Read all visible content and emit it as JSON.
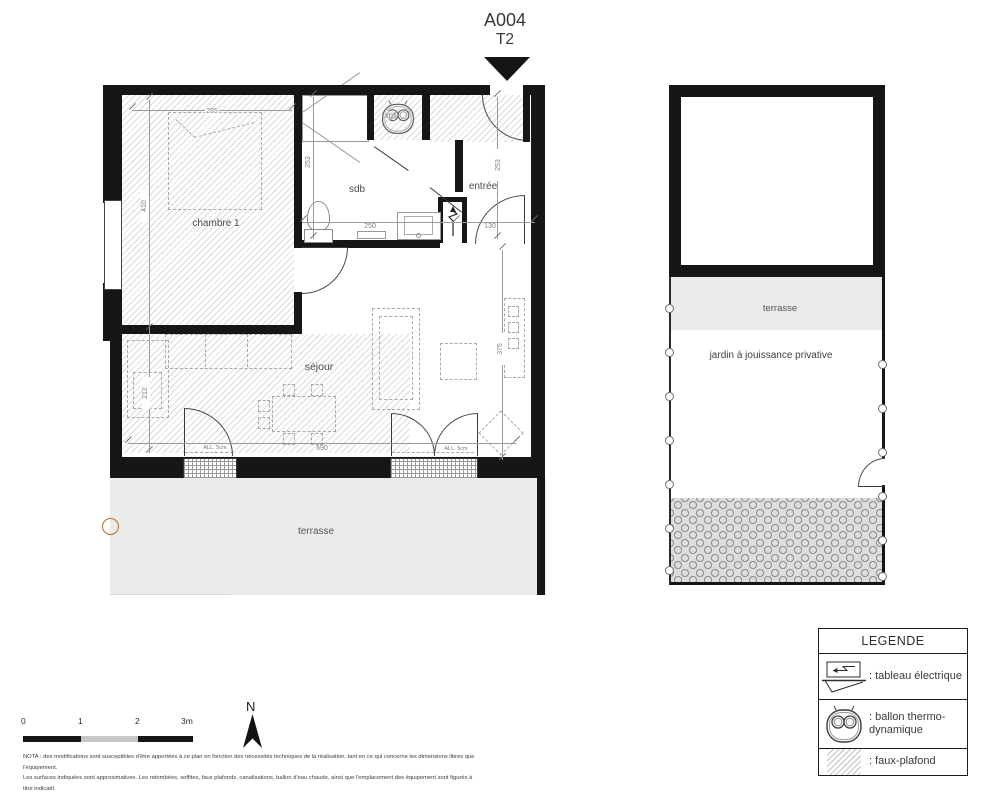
{
  "title": {
    "lot": "A004",
    "unit_type": "T2"
  },
  "plan": {
    "rooms": {
      "chambre": "chambre 1",
      "sdb": "sdb",
      "rgt": "rgt",
      "entree": "entrée",
      "sejour": "séjour",
      "terrasse": "terrasse"
    },
    "dims": {
      "chambre_width": "285",
      "chambre_height": "410",
      "sdb_height": "253",
      "sdb_width": "250",
      "entree_height": "253",
      "entree_width": "130",
      "sejour_width": "690",
      "sejour_height": "375",
      "cuisine_height": "212"
    },
    "windows": {
      "left_allege": "ALL. 5cm",
      "right_allege": "ALL. 5cm"
    }
  },
  "site": {
    "terrasse": "terrasse",
    "jardin": "jardin à jouissance privative"
  },
  "legend": {
    "title": "LEGENDE",
    "items": [
      {
        "name": "tableau-electrique",
        "label": ": tableau électrique"
      },
      {
        "name": "ballon-thermodynamique",
        "label": ": ballon thermo-dynamique"
      },
      {
        "name": "faux-plafond",
        "label": ": faux-plafond"
      }
    ]
  },
  "scalebar": {
    "t0": "0",
    "t1": "1",
    "t2": "2",
    "t3": "3m"
  },
  "compass": {
    "north": "N"
  },
  "nota": {
    "line1": "NOTA : des modifications sont susceptibles d'être apportées à ce plan en fonction des nécessités techniques de la réalisation, tant en ce qui concerne les dimensions libres que l'équipement.",
    "line2": "Les surfaces indiquées sont approximatives. Les retombées, soffites, faux plafonds, canalisations, ballon d'eau chaude, ainsi que l'emplacement des équipement sont figurés à titre indicatif."
  },
  "colors": {
    "wall": "#161616",
    "terrace_fill": "#ebebe9",
    "accent_orange": "#b06a32",
    "dim_text": "#7e7e7e",
    "room_text": "#4d4d4d"
  }
}
